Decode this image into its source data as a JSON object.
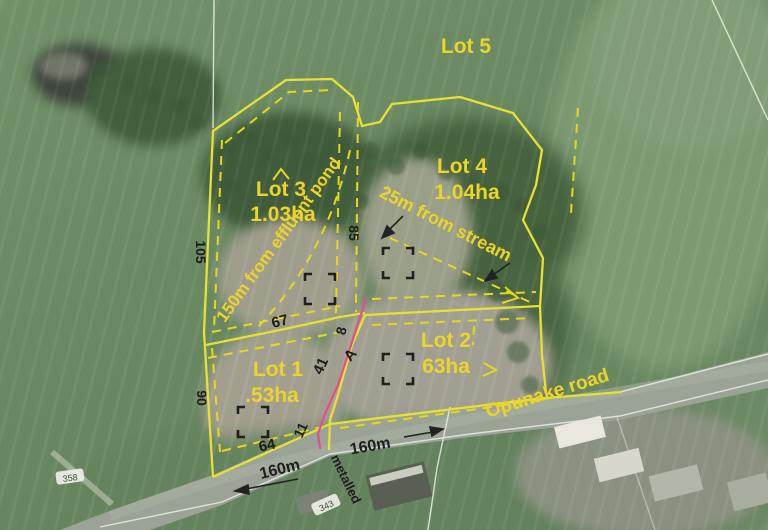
{
  "map_title": "Aerial subdivision plan",
  "lots": {
    "lot1": {
      "name": "Lot 1",
      "area": ".53ha"
    },
    "lot2": {
      "name": "Lot 2",
      "area": "63ha"
    },
    "lot3": {
      "name": "Lot 3",
      "area": "1.03ha"
    },
    "lot4": {
      "name": "Lot 4",
      "area": "1.04ha"
    },
    "lot5": {
      "name": "Lot 5"
    }
  },
  "setbacks": {
    "effluent": "150m from effluent pond",
    "stream": "25m from stream"
  },
  "road": {
    "name": "Opunake road",
    "surface": "metalled",
    "frontage_west": "160m",
    "frontage_east": "160m",
    "marker_west": "358",
    "marker_east": "343"
  },
  "dimensions": {
    "west_upper": "105",
    "west_lower": "90",
    "corridor_east": "85",
    "lot1_north": "67",
    "lot1_south": "64",
    "accessway_length": "41",
    "accessway_width": "8",
    "frontage_strip": "11",
    "point_a": "A"
  },
  "colors": {
    "boundary_yellow": "#e8e032",
    "label_yellow": "#edd428",
    "accessway_pink": "#e0508e",
    "dimension_black": "#1d1d1d"
  }
}
